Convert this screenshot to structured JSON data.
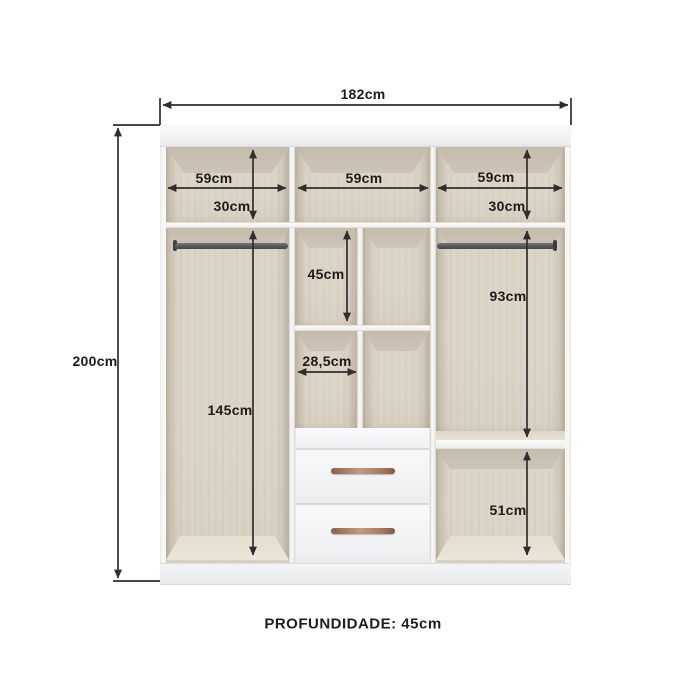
{
  "wardrobe": {
    "footer_label": "PROFUNDIDADE: 45cm",
    "dimensions": {
      "total_width": "182cm",
      "total_height": "200cm",
      "left_section_width": "59cm",
      "middle_section_width": "59cm",
      "right_section_width": "59cm",
      "left_top_shelf_height": "30cm",
      "right_top_shelf_height": "30cm",
      "middle_upper_height": "45cm",
      "middle_column_width": "28,5cm",
      "left_hanging_height": "145cm",
      "right_hanging_height": "93cm",
      "right_bottom_height": "51cm"
    },
    "colors": {
      "wood": "#ddd6c8",
      "panel_white": "#f6f6f4",
      "dimension_line": "#2e2e2e",
      "handle_copper": "#a9785e",
      "rod_gray": "#54585c"
    }
  }
}
